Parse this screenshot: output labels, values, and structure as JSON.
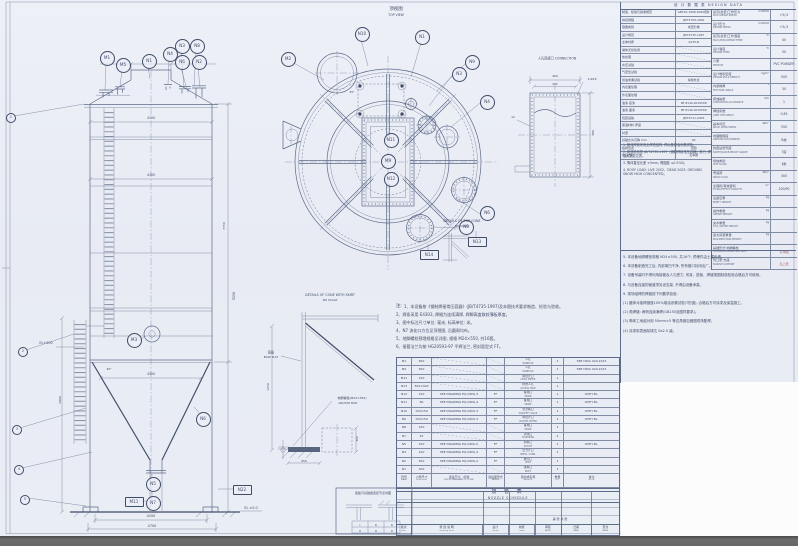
{
  "page": {
    "bg": "#e9edf4",
    "white": "#fcfcfd",
    "line": "#5d6b8a",
    "line_heavy": "#3f4c68",
    "text": "#414d69",
    "red": "#b4606e",
    "band": "#6a6a6a"
  },
  "titles": {
    "design_header": "设 计 数 据 表   DESIGN DATA",
    "schedule_cn": "接 管 表",
    "schedule_en": "NOZZLE SCHEDULE",
    "notes_head": "注:"
  },
  "balloons": [
    {
      "t": "M1",
      "x": 106,
      "y": 57
    },
    {
      "t": "M5",
      "x": 122,
      "y": 64
    },
    {
      "t": "N1",
      "x": 148,
      "y": 60
    },
    {
      "t": "N4",
      "x": 169,
      "y": 53
    },
    {
      "t": "N3",
      "x": 181,
      "y": 45
    },
    {
      "t": "N8",
      "x": 196,
      "y": 45
    },
    {
      "t": "N6",
      "x": 181,
      "y": 61
    },
    {
      "t": "N2",
      "x": 198,
      "y": 61
    },
    {
      "t": "M3",
      "x": 133,
      "y": 339
    },
    {
      "t": "N6",
      "x": 202,
      "y": 418
    },
    {
      "t": "N5",
      "x": 152,
      "y": 483
    },
    {
      "t": "N7",
      "x": 152,
      "y": 502
    },
    {
      "t": "M11",
      "x": 133,
      "y": 501,
      "box": true
    },
    {
      "t": "N22",
      "x": 241,
      "y": 489,
      "box": true
    },
    {
      "t": "M2",
      "x": 287,
      "y": 58
    },
    {
      "t": "N10",
      "x": 361,
      "y": 33
    },
    {
      "t": "N1",
      "x": 421,
      "y": 36
    },
    {
      "t": "N9",
      "x": 471,
      "y": 61
    },
    {
      "t": "N3",
      "x": 458,
      "y": 73
    },
    {
      "t": "N4",
      "x": 486,
      "y": 101
    },
    {
      "t": "N6",
      "x": 486,
      "y": 212
    },
    {
      "t": "N5",
      "x": 465,
      "y": 226
    },
    {
      "t": "N13",
      "x": 476,
      "y": 241,
      "box": true
    },
    {
      "t": "N14",
      "x": 428,
      "y": 254,
      "box": true
    },
    {
      "t": "N11",
      "x": 390,
      "y": 139
    },
    {
      "t": "M9",
      "x": 387,
      "y": 160
    },
    {
      "t": "N12",
      "x": 390,
      "y": 178
    },
    {
      "t": "1",
      "x": 10,
      "y": 117,
      "small": true
    },
    {
      "t": "2",
      "x": 22,
      "y": 351,
      "small": true
    },
    {
      "t": "3",
      "x": 16,
      "y": 429,
      "small": true
    },
    {
      "t": "4",
      "x": 18,
      "y": 469,
      "small": true
    },
    {
      "t": "5",
      "x": 24,
      "y": 499,
      "small": true
    }
  ],
  "annotations": [
    {
      "t": "顶视图",
      "x": 396,
      "y": 9,
      "s": 4.5
    },
    {
      "t": "TOP VIEW",
      "x": 396,
      "y": 14.5,
      "s": 3.2
    },
    {
      "t": "DETAILS OF TOP CONE",
      "x": 462,
      "y": 221,
      "s": 3.3
    },
    {
      "t": "NO SCALE",
      "x": 462,
      "y": 226,
      "s": 2.9
    },
    {
      "t": "DETAILS OF CONE WITH SKIRT",
      "x": 330,
      "y": 295,
      "s": 3.3
    },
    {
      "t": "NO SCALE",
      "x": 330,
      "y": 300,
      "s": 2.9
    },
    {
      "t": "人孔连接口 CONNECTION",
      "x": 557,
      "y": 58,
      "s": 3.2
    },
    {
      "t": "460",
      "x": 555,
      "y": 76,
      "s": 3
    },
    {
      "t": "425",
      "x": 555,
      "y": 84,
      "s": 2.8
    },
    {
      "t": "780",
      "x": 593,
      "y": 133,
      "r": -90,
      "s": 3
    },
    {
      "t": "2-Φ18",
      "x": 592,
      "y": 79,
      "s": 2.9
    },
    {
      "t": "12",
      "x": 513,
      "y": 117,
      "s": 3
    },
    {
      "t": "EL+500",
      "x": 46,
      "y": 343,
      "s": 3.4
    },
    {
      "t": "EL ±0.0",
      "x": 251,
      "y": 508,
      "s": 3.4
    },
    {
      "t": "4100",
      "x": 151,
      "y": 118,
      "s": 3.2
    },
    {
      "t": "4100",
      "x": 151,
      "y": 175,
      "s": 3.2
    },
    {
      "t": "4300",
      "x": 151,
      "y": 374,
      "s": 3.2
    },
    {
      "t": "4200",
      "x": 151,
      "y": 516,
      "s": 3.4
    },
    {
      "t": "4700",
      "x": 152,
      "y": 525.5,
      "s": 3.4
    },
    {
      "t": "45°",
      "x": 109,
      "y": 369,
      "s": 3
    },
    {
      "t": "45°",
      "x": 352,
      "y": 92,
      "s": 3
    },
    {
      "t": "9250",
      "x": 234,
      "y": 296,
      "r": -90,
      "s": 3.2
    },
    {
      "t": "7750",
      "x": 224,
      "y": 226,
      "r": -90,
      "s": 3
    },
    {
      "t": "5800",
      "x": 60,
      "y": 400,
      "r": -90,
      "s": 3
    },
    {
      "t": "底板",
      "x": 271,
      "y": 352,
      "s": 3.2
    },
    {
      "t": "BASE PLAT",
      "x": 271,
      "y": 356.5,
      "s": 2.7
    },
    {
      "t": "地脚螺栓(M24×550)",
      "x": 352,
      "y": 398,
      "s": 3
    },
    {
      "t": "ANCHOR BOLT",
      "x": 348,
      "y": 402.5,
      "s": 2.7
    },
    {
      "t": "1250",
      "x": 268,
      "y": 387,
      "r": -90,
      "s": 3
    },
    {
      "t": "450",
      "x": 304,
      "y": 461,
      "s": 3
    },
    {
      "t": "300",
      "x": 357,
      "y": 439,
      "r": -90,
      "s": 2.8
    },
    {
      "t": "第 张  共 张",
      "x": 560,
      "y": 519,
      "s": 3
    },
    {
      "t": "底板与基础梁连接节点详图",
      "x": 373,
      "y": 493,
      "s": 3
    },
    {
      "t": "Ⅰ",
      "x": 360,
      "y": 524.5,
      "s": 3
    },
    {
      "t": "6",
      "x": 376,
      "y": 524.5,
      "s": 3
    },
    {
      "t": "6",
      "x": 392,
      "y": 524.5,
      "s": 3
    },
    {
      "t": "Ⅱ",
      "x": 360,
      "y": 530.5,
      "s": 3
    },
    {
      "t": "6",
      "x": 376,
      "y": 530.5,
      "s": 3
    },
    {
      "t": "6",
      "x": 392,
      "y": 530.5,
      "s": 3
    }
  ],
  "mid_notes": [
    "1、本设备按《钢制焊接常压容器》(JB/T4735-1997)及本图技术要求制造、检验与验收。",
    "2、焊条采用 E4303, 焊缝为连续满焊, 焊脚高度取较薄板厚度。",
    "3、图中标注尺寸单位: 毫米, 标高单位: 米。",
    "4、N7 流化口方位见顶视图, 沿圆周均布。",
    "5、地脚螺栓预埋规格见详图, 规格 M24×550, 共16套。",
    "6、接管法兰均按 HG20593-97 平焊法兰, 密封面型式 FF。"
  ],
  "schedule": {
    "headers": [
      {
        "cn": "符号",
        "en": "MARK"
      },
      {
        "cn": "公称尺寸",
        "en": "NOM.SIZE"
      },
      {
        "cn": "连接尺寸、标准",
        "en": "SIZE & STANDARD OF CONN."
      },
      {
        "cn": "连接面形式",
        "en": "FACING"
      },
      {
        "cn": "用途或名称",
        "en": "SERVICE"
      },
      {
        "cn": "数量",
        "en": "QTY"
      },
      {
        "cn": "备注",
        "en": "NOTE"
      }
    ],
    "rows": [
      [
        "M1",
        "500",
        "",
        "",
        "人孔",
        "MANHOLE",
        "1",
        "SEE DWG 020-2013"
      ],
      [
        "M2",
        "500",
        "",
        "",
        "人孔",
        "MANHOLE",
        "1",
        "SEE DWG 020-2013"
      ],
      [
        "M11",
        "150",
        "",
        "",
        "料位计口",
        "LEVEL METER",
        "1",
        ""
      ],
      [
        "N13",
        "500×400",
        "",
        "",
        "检修人孔",
        "ACCESS HOLE",
        "1",
        ""
      ],
      [
        "N12",
        "150",
        "SEE DRAWING EQ-DWG-3",
        "FF",
        "备用口",
        "SPARE",
        "1",
        "WITH BL."
      ],
      [
        "N11",
        "80",
        "SEE DRAWING EQ-DWG-4",
        "FF",
        "备用口",
        "SPARE",
        "1",
        "WITH BL."
      ],
      [
        "N10",
        "150/150",
        "SEE DRAWING EQ-DWG-3",
        "FF",
        "安全阀口",
        "W/SAFETY VALVE",
        "1",
        "WITH BL."
      ],
      [
        "N9",
        "150/150",
        "SEE DRAWING EQ-DWG-3",
        "FF",
        "料位计口",
        "W/LEVEL METER",
        "1",
        "WITH BL."
      ],
      [
        "N8",
        "150",
        "",
        "",
        "备用口",
        "SPARE",
        "1",
        ""
      ],
      [
        "N7",
        "25",
        "",
        "",
        "流化口",
        "FLUIDIZING",
        "4",
        ""
      ],
      [
        "N5",
        "250",
        "SEE DRAWING EQ-DWG-5",
        "FF",
        "卸料口",
        "OUTLET",
        "1",
        "WITH BL."
      ],
      [
        "N4",
        "100",
        "SEE DRAWING EQ-DWG-3",
        "FF",
        "压力计口",
        "PRESS. CONN.",
        "1",
        ""
      ],
      [
        "N2",
        "500",
        "SEE DRAWING EQ-DWG-2",
        "FF",
        "放空口",
        "VENT",
        "1",
        ""
      ],
      [
        "N1",
        "300",
        "",
        "",
        "进料口",
        "INLET",
        "1",
        ""
      ]
    ]
  },
  "revision": {
    "cols": [
      {
        "cn": "版次",
        "en": "REV.",
        "w": 14
      },
      {
        "cn": "修 改 说 明",
        "en": "DESCRIPTION",
        "w": 72
      },
      {
        "cn": "设计",
        "en": "DSGN",
        "w": 26
      },
      {
        "cn": "校核",
        "en": "CHKD",
        "w": 26
      },
      {
        "cn": "审核",
        "en": "APPD",
        "w": 26
      },
      {
        "cn": "日期",
        "en": "DATE",
        "w": 30
      },
      {
        "cn": "页次",
        "en": "PAGE",
        "w": 28
      }
    ]
  },
  "design_left": [
    [
      "制造、检验与验收规范",
      "GB150-1998·2000增补"
    ],
    [
      "焊接规程",
      "JB/T4709-2000"
    ],
    [
      "容器类别",
      "常压贮槽"
    ],
    [
      "设计规范",
      "JB/T4735-1997"
    ],
    [
      "主体材质",
      "Q235-B"
    ],
    [
      "罐体无损检测",
      "/"
    ],
    [
      "热处理",
      "/"
    ],
    [
      "水压试验",
      "/"
    ],
    [
      "气密性试验",
      "/"
    ],
    [
      "煤油渗漏试验",
      "焊缝检查"
    ],
    [
      "内表面处理",
      "/"
    ],
    [
      "外表面处理",
      "/"
    ],
    [
      "油漆·底漆",
      "PE 8140-2010508"
    ],
    [
      "油漆·面漆",
      "PE 8140-2010509"
    ],
    [
      "包装运输",
      "JB/T4711-2003"
    ],
    [
      "保温材料·厚度",
      "/"
    ],
    [
      "衬里",
      "/"
    ],
    [
      "基础允许沉降 mm",
      "90"
    ],
    [
      "铭牌位置",
      "见图"
    ],
    [
      "管口方位",
      "见本图"
    ]
  ],
  "design_right": [
    {
      "c": "最高(最低)工作压力",
      "e": "MAX.OPERAT.PRESS.",
      "u": "mmH2O",
      "v": "+5/-5"
    },
    {
      "c": "设计压力",
      "e": "DESIGN PRESS.",
      "u": "mmH2O",
      "v": "+5/-5"
    },
    {
      "c": "最高(最低)工作温度",
      "e": "MAX.(MIN.)OPERAT.TEMP",
      "u": "℃",
      "v": "40"
    },
    {
      "c": "设计温度",
      "e": "DESIGN TEMP.",
      "u": "℃",
      "v": "50"
    },
    {
      "c": "介质",
      "e": "MEDIUM",
      "u": "",
      "v": "PVC POWDER"
    },
    {
      "c": "设计堆积密度",
      "e": "DESIGN BULK DENSITY",
      "u": "kg/m³",
      "v": "500"
    },
    {
      "c": "内摩擦角",
      "e": "FRICTION ANGLE",
      "u": "°",
      "v": "30"
    },
    {
      "c": "腐蚀裕量",
      "e": "CORROSION ALLOWANCE",
      "u": "mm",
      "v": "1"
    },
    {
      "c": "焊缝系数",
      "e": "JOINT EFFICIENCY",
      "u": "",
      "v": "0.85"
    },
    {
      "c": "基本风压",
      "e": "BASIC WIND PRESS.",
      "u": "N/m²",
      "v": "550"
    },
    {
      "c": "地面粗糙度",
      "e": "GROUND ROUGHNESS",
      "u": "",
      "v": "B类"
    },
    {
      "c": "抗震设防烈度",
      "e": "EARTHQUAKE-PROOF GRADE",
      "u": "",
      "v": "7度"
    },
    {
      "c": "场地类别",
      "e": "SITE CLASS",
      "u": "",
      "v": "Ⅱ类"
    },
    {
      "c": "雪载荷",
      "e": "SNOW LOAD",
      "u": "N/m²",
      "v": "300"
    },
    {
      "c": "全容积/有效容积",
      "e": "TOTAL/EFFECT.CAPACITY",
      "u": "m³",
      "v": "100/90"
    },
    {
      "c": "设备空重",
      "e": "EMPTY WEIGHT",
      "u": "kg",
      "v": ""
    },
    {
      "c": "操作重量",
      "e": "OPERAT.WEIGHT",
      "u": "kg",
      "v": ""
    },
    {
      "c": "充水重量",
      "e": "FULL WATER WEIGHT",
      "u": "kg",
      "v": ""
    },
    {
      "c": "最大吊装重量",
      "e": "MAX.ERECTION WEIGHT",
      "u": "kg",
      "v": ""
    },
    {
      "c": "基础形式·地脚螺栓",
      "e": "FOUNDATION·ANCHOR BOLT",
      "u": "",
      "v": "见本图",
      "red": true
    },
    {
      "c": "管口表·支座",
      "e": "NOZZLE·SUPPORT",
      "u": "",
      "v": "见上表",
      "red": true
    }
  ],
  "panel_notes_upper": [
    "1. 罐体焊缝采用全焊透结构, 焊后做煤油渗漏试验。",
    "2. 制造检验按 JB/T4735-1997《钢制焊接常压容器》执行, 焊缝系数见左表。",
    "3. 筒体直径允差 ±5mm, 椭圆度 ≤0.5%D。",
    "4. ROOF LOAD: LIVE 2002、DEAD 2003, GROUND SNOW HIGH CONCENTED。"
  ],
  "panel_notes_lower": [
    "5. 本设备地脚螺栓规格 M24×550, 共16个, 预埋件由土建负责。",
    "6. 本设备制造完工后, 内部清扫干净, 所有管口封闭出厂。",
    "7. 设备吊装时不得利用接管及人孔受力, 吊耳、垫板、焊缝按图制造检验合格后方可使用。",
    "8. 与设备连接的管道须另设支架, 不得由设备承重。",
    "9. 现场组焊的焊缝按下列要求检验:",
    "(1) 罐体对接焊缝做100%煤油渗漏试验(T形缝), 合格后方可涂漆及保温施工。",
    "(2) 角焊缝: 两侧连续满焊(GB150及图样要求)。",
    "(3) 筒体工地组对用 50mm×5 等边角钢加固圈现场配焊。",
    "(4) 涂漆前表面除锈达 Sa2.5 级。"
  ]
}
